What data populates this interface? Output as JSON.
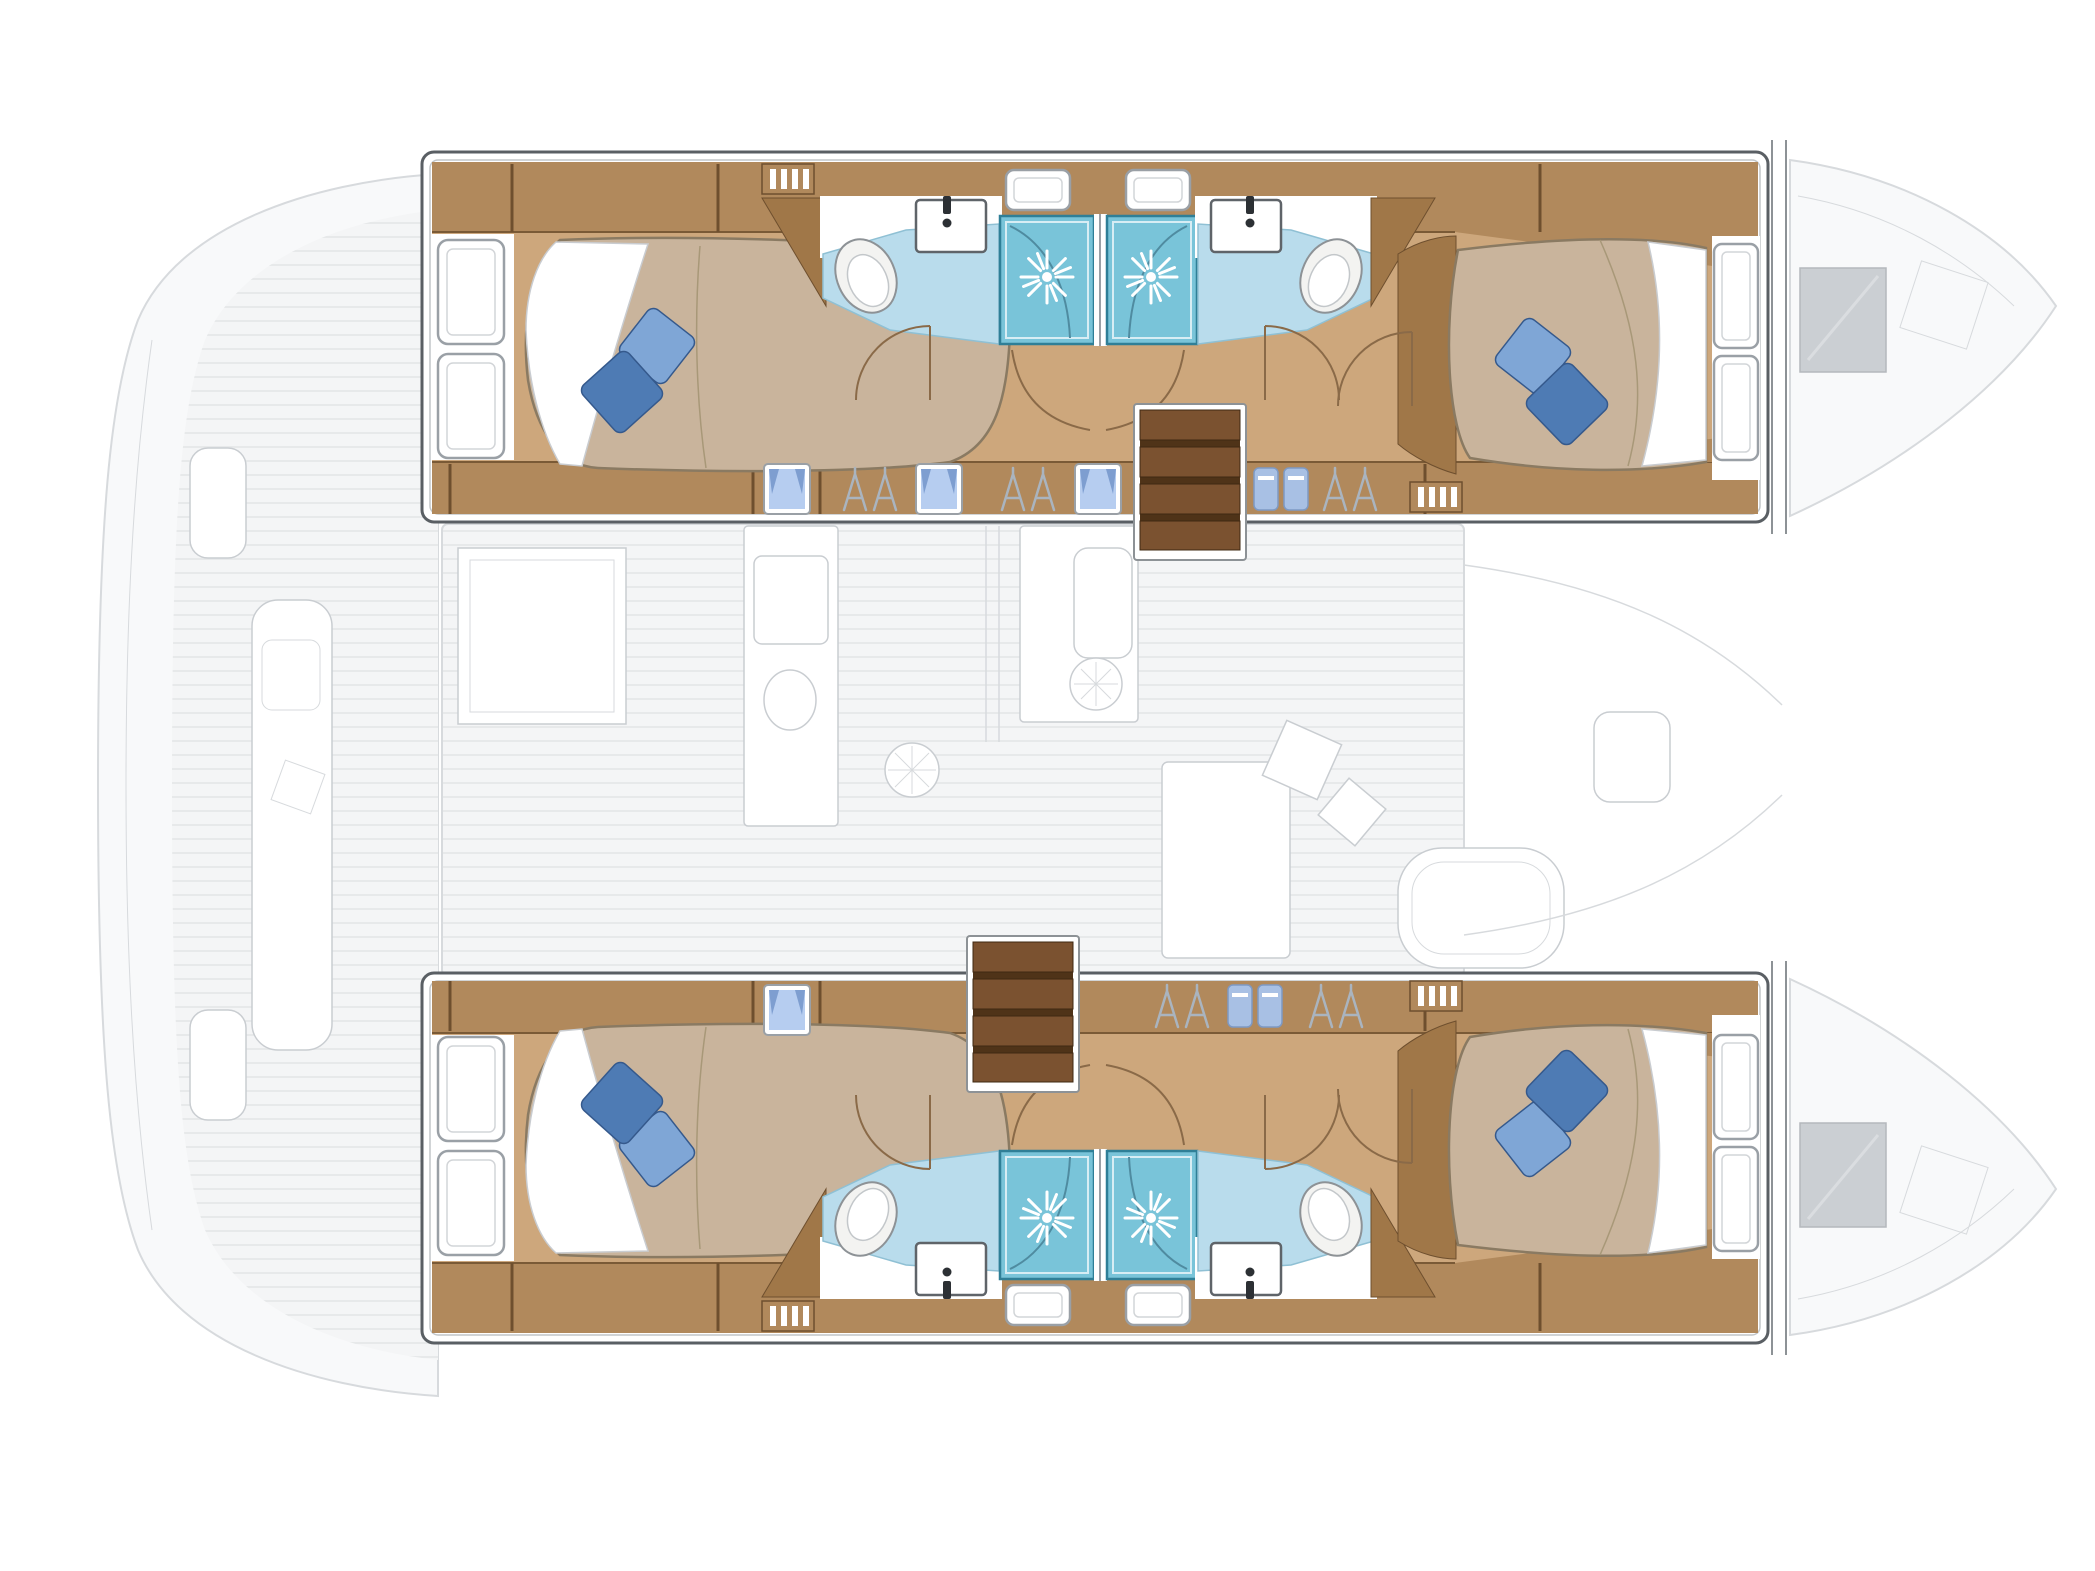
{
  "diagram": {
    "type": "yacht-interior-floor-plan",
    "vessel_type": "sailing-catamaran",
    "layout_version": "4 double cabins / 4 bathrooms with separate shower stalls",
    "view": "top-down deck plan, bow to the right, stern to the left",
    "description": "Catamaran lower-deck floor plan: two symmetrical hulls each with an aft island double bed cabin, a forward island double bed cabin, two bathrooms with toilet, washbasin and glass shower stall, wardrobe lockers and a companionway staircase; saloon, galley, cockpit, crossbeam and bows are shown as faint gray outlines."
  },
  "colors": {
    "outline": "#5a5f64",
    "wood": "#b1895c",
    "woodDark": "#6e4f2e",
    "woodFloor": "#cda77c",
    "woodWall": "#a07748",
    "stairs": "#7b5230",
    "stairsDark": "#4f3318",
    "bedTan": "#c9b49c",
    "bedEdge": "#8a7a62",
    "pillowLight": "#7fa6d6",
    "pillowDark": "#4e7bb4",
    "pillowEdge": "#35598c",
    "bath": "#b9dcec",
    "bathEdge": "#8fc0d4",
    "shower": "#79c4d9",
    "showerEdge": "#2f7f97",
    "windowFrame": "#9aa0a6",
    "curtain": "#7e9ed0",
    "curtainGlass": "#b6cdf0",
    "towel": "#a8c0e4",
    "hanger": "#aab4bf",
    "doorArc": "#8a6a48",
    "ghostFill": "#f8f9fa",
    "ghostLine": "#d7dadd",
    "ghostDark": "#c9cdd1",
    "hatch": "#cbcfd3"
  },
  "hulls": [
    {
      "id": "port-hull",
      "position": "top",
      "aft_cabin": {
        "bed": "island double",
        "pillows": 2,
        "hull_windows": 2,
        "curtained_portlights": 1
      },
      "aft_bathroom": {
        "toilet": 1,
        "washbasin": 1,
        "shower_stall": 1,
        "shower_head": 1
      },
      "fwd_bathroom": {
        "toilet": 1,
        "washbasin": 1,
        "shower_stall": 1,
        "shower_head": 1
      },
      "fwd_cabin": {
        "bed": "island double",
        "pillows": 2,
        "hull_windows": 2
      },
      "companionway": {
        "steps": 4,
        "location": "amidships, aft of forward bathroom"
      },
      "wardrobes": {
        "hanger_lockers": 3,
        "towel_shelves": 1,
        "curtained_portlights": 3,
        "vent_grilles": 2
      }
    },
    {
      "id": "starboard-hull",
      "position": "bottom",
      "aft_cabin": {
        "bed": "island double",
        "pillows": 2,
        "hull_windows": 2,
        "curtained_portlights": 1
      },
      "aft_bathroom": {
        "toilet": 1,
        "washbasin": 1,
        "shower_stall": 1,
        "shower_head": 1
      },
      "fwd_bathroom": {
        "toilet": 1,
        "washbasin": 1,
        "shower_stall": 1,
        "shower_head": 1
      },
      "fwd_cabin": {
        "bed": "island double",
        "pillows": 2,
        "hull_windows": 2
      },
      "companionway": {
        "steps": 4,
        "location": "amidships, forward of galley"
      },
      "wardrobes": {
        "hanger_lockers": 2,
        "towel_shelves": 1,
        "curtained_portlights": 1,
        "vent_grilles": 2
      }
    }
  ],
  "saloon_ghost": {
    "features": [
      "chart-table",
      "galley-counter-port",
      "galley-counter-starboard",
      "galley-sink",
      "stove-burner",
      "fridge",
      "dinette-table",
      "curved-sofa",
      "scatter-cushions",
      "companionway-opening"
    ]
  },
  "cockpit_ghost": {
    "features": [
      "aft-deck",
      "side-bench",
      "helm-seat",
      "transom-platforms"
    ]
  },
  "foredeck_ghost": {
    "features": [
      "crossbeam",
      "bow-hatches",
      "bow-lockers",
      "forward-seat"
    ]
  }
}
